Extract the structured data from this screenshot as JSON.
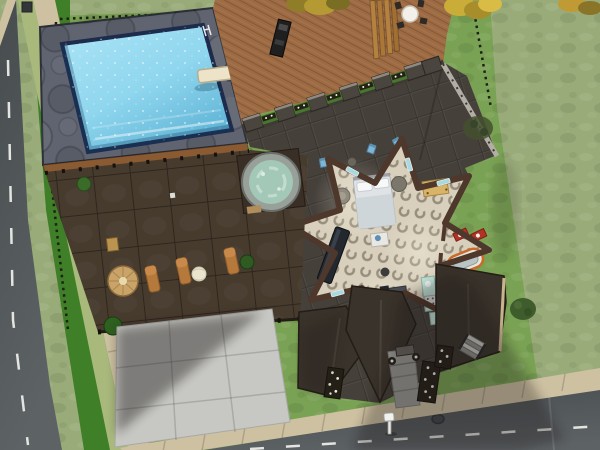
{
  "scene": {
    "description": "Overhead lot view from a life-simulation game: swimming pool with diving board, wooden deck with patio table, dark tiled terrace with hot tub and wicker loungers, and a star-shaped house interior with bed, bar, desk, kitchen and bathroom, bordered by streets on two sides.",
    "view": "top-down isometric lot view",
    "hud_text": ""
  },
  "objects": {
    "swimming_pool": "Swimming pool",
    "diving_board": "Diving board",
    "pool_ladder": "Pool ladder",
    "wood_deck": "Wooden deck",
    "deck_table": "Round patio table with chairs",
    "grill": "Barbecue grill",
    "hot_tub": "Hot tub",
    "umbrella_table": "Wicker umbrella table",
    "lounge_chair": "Wicker lounge chair",
    "beach_ball": "Beach ball",
    "star_room": "Star-shaped room",
    "double_bed": "Double bed",
    "bar_table": "Dark bar table",
    "coffee_table": "Small white table",
    "computer_desk": "Computer desk",
    "kitchen_counter": "Mint kitchen counter",
    "fridge": "Refrigerator",
    "bathtub": "Orange-trimmed bathtub",
    "bathroom_sinks": "Red bathroom counters",
    "dining_table_yellow": "Tan table",
    "blue_chair": "Blue chair",
    "entry_door": "Front door",
    "porch_lamp": "Porch lamp",
    "flower_planter": "Planter with white flowers",
    "stairs": "Exterior stairs",
    "driveway": "Concrete driveway",
    "entry_path": "Entry path",
    "mailbox": "Mailbox",
    "trash_can": "Trash can",
    "shrub": "Shrub",
    "tree_foliage": "Tree foliage",
    "street": "Street",
    "sidewalk": "Sidewalk",
    "lot_fence": "Lot boundary fence",
    "storm_drain": "Storm drain"
  },
  "palette": {
    "grass_light": "#99ab79",
    "grass_lot": "#7aa254",
    "grass_dark": "#3f7f27",
    "verge": "#a9b97c",
    "road": "#565b5e",
    "road_line": "#e4e4e0",
    "sidewalk": "#cec1a2",
    "pool_stone": "#5f6470",
    "pool_water": "#8fd6ee",
    "pool_border": "#1d2b4d",
    "deck_wood": "#9c6a43",
    "patio_tile": "#473b2e",
    "terrace_roof": "#45403a",
    "gable_roof": "#3a332b",
    "wall_brown": "#4e372b",
    "floor_cream": "#d8d0bd",
    "driveway": "#c7c8c3",
    "hot_tub_water": "#a4c8b8",
    "flower_white": "#f0f0e8",
    "foliage_yellow": "#c2a437",
    "accent_teal": "#a5dbe0",
    "accent_mint": "#bfe2d6",
    "accent_red": "#b23326",
    "accent_navy": "#23272e",
    "bathtub_orange": "#c86a28"
  }
}
